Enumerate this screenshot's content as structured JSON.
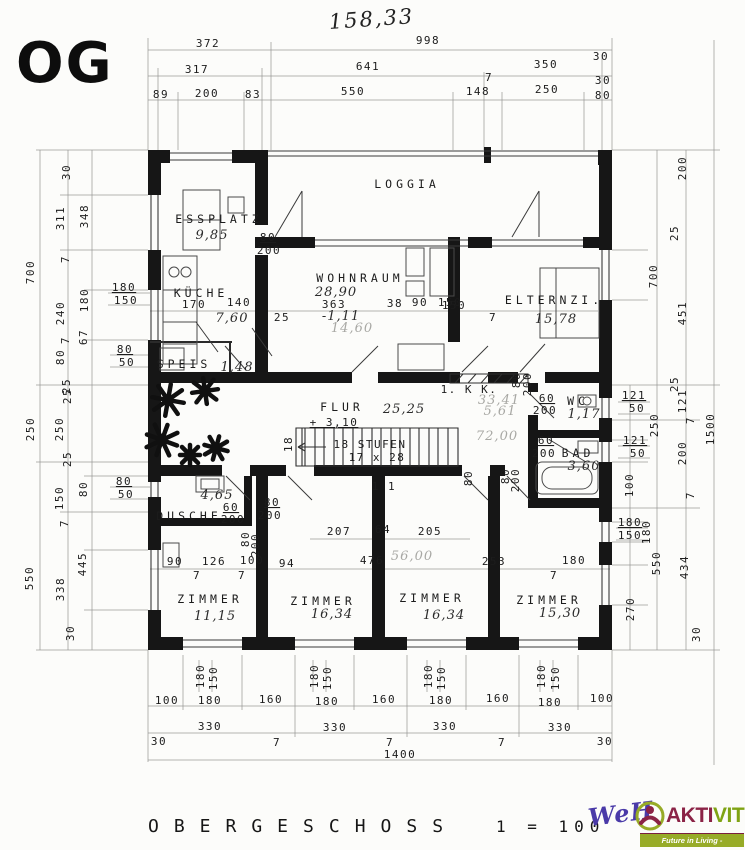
{
  "header": {
    "floor_code": "OG",
    "handwritten_total": "158,33"
  },
  "footer": {
    "title": "OBERGESCHOSS",
    "scale": "1 = 100",
    "logo": {
      "handwritten": "WeH",
      "brand_left": "AKTI",
      "brand_right": "VIT",
      "tagline": "Future in Living - Immobilien.",
      "colors": {
        "handwritten": "#4a3aa8",
        "brand_left": "#8b2346",
        "brand_right": "#7fa314",
        "banner_bg": "#97ab27",
        "tagline_text": "#ffffff"
      }
    }
  },
  "labels": [
    {
      "t": "372",
      "x": 208,
      "y": 47
    },
    {
      "t": "998",
      "x": 428,
      "y": 44
    },
    {
      "t": "317",
      "x": 197,
      "y": 73
    },
    {
      "t": "641",
      "x": 368,
      "y": 70
    },
    {
      "t": "7",
      "x": 489,
      "y": 81,
      "s": 10
    },
    {
      "t": "350",
      "x": 546,
      "y": 68
    },
    {
      "t": "30",
      "x": 601,
      "y": 60,
      "s": 10
    },
    {
      "t": "30",
      "x": 603,
      "y": 84,
      "s": 10
    },
    {
      "t": "89",
      "x": 161,
      "y": 98
    },
    {
      "t": "200",
      "x": 207,
      "y": 97
    },
    {
      "t": "83",
      "x": 253,
      "y": 98
    },
    {
      "t": "550",
      "x": 353,
      "y": 95
    },
    {
      "t": "148",
      "x": 478,
      "y": 95
    },
    {
      "t": "250",
      "x": 547,
      "y": 93
    },
    {
      "t": "80",
      "x": 603,
      "y": 99,
      "s": 10
    },
    {
      "t": "700",
      "x": 34,
      "y": 272,
      "r": -90
    },
    {
      "t": "30",
      "x": 70,
      "y": 172,
      "r": -90,
      "s": 10
    },
    {
      "t": "311",
      "x": 64,
      "y": 218,
      "r": -90
    },
    {
      "t": "348",
      "x": 88,
      "y": 216,
      "r": -90
    },
    {
      "t": "7",
      "x": 69,
      "y": 259,
      "r": -90,
      "s": 10
    },
    {
      "t": "240",
      "x": 64,
      "y": 313,
      "r": -90
    },
    {
      "t": "180",
      "x": 88,
      "y": 300,
      "r": -90
    },
    {
      "t": "180",
      "x": 124,
      "y": 291,
      "u": 1
    },
    {
      "t": "150",
      "x": 126,
      "y": 304
    },
    {
      "t": "67",
      "x": 87,
      "y": 337,
      "r": -90,
      "s": 10
    },
    {
      "t": "7",
      "x": 69,
      "y": 340,
      "r": -90,
      "s": 10
    },
    {
      "t": "80",
      "x": 64,
      "y": 357,
      "r": -90
    },
    {
      "t": "80",
      "x": 125,
      "y": 353,
      "u": 1
    },
    {
      "t": "50",
      "x": 127,
      "y": 366
    },
    {
      "t": "25",
      "x": 70,
      "y": 386,
      "r": -90,
      "s": 10
    },
    {
      "t": "250",
      "x": 34,
      "y": 429,
      "r": -90
    },
    {
      "t": "250",
      "x": 63,
      "y": 429,
      "r": -90
    },
    {
      "t": "25",
      "x": 71,
      "y": 396,
      "r": -90,
      "s": 10
    },
    {
      "t": "25",
      "x": 71,
      "y": 459,
      "r": -90,
      "s": 10
    },
    {
      "t": "80",
      "x": 124,
      "y": 485,
      "u": 1
    },
    {
      "t": "50",
      "x": 126,
      "y": 498
    },
    {
      "t": "80",
      "x": 87,
      "y": 489,
      "r": -90
    },
    {
      "t": "150",
      "x": 63,
      "y": 498,
      "r": -90
    },
    {
      "t": "7",
      "x": 68,
      "y": 523,
      "r": -90,
      "s": 10
    },
    {
      "t": "550",
      "x": 33,
      "y": 578,
      "r": -90
    },
    {
      "t": "445",
      "x": 86,
      "y": 564,
      "r": -90
    },
    {
      "t": "338",
      "x": 64,
      "y": 589,
      "r": -90
    },
    {
      "t": "30",
      "x": 74,
      "y": 633,
      "r": -90,
      "s": 10
    },
    {
      "t": "200",
      "x": 686,
      "y": 168,
      "r": -90
    },
    {
      "t": "25",
      "x": 678,
      "y": 233,
      "r": -90,
      "s": 10
    },
    {
      "t": "700",
      "x": 657,
      "y": 276,
      "r": -90
    },
    {
      "t": "451",
      "x": 686,
      "y": 313,
      "r": -90
    },
    {
      "t": "25",
      "x": 678,
      "y": 384,
      "r": -90,
      "s": 10
    },
    {
      "t": "121",
      "x": 634,
      "y": 399,
      "u": 1
    },
    {
      "t": "50",
      "x": 637,
      "y": 412
    },
    {
      "t": "250",
      "x": 658,
      "y": 425,
      "r": -90
    },
    {
      "t": "121",
      "x": 686,
      "y": 401,
      "r": -90
    },
    {
      "t": "7",
      "x": 694,
      "y": 420,
      "r": -90,
      "s": 10
    },
    {
      "t": "1500",
      "x": 714,
      "y": 429,
      "r": -90
    },
    {
      "t": "121",
      "x": 635,
      "y": 444,
      "u": 1
    },
    {
      "t": "50",
      "x": 638,
      "y": 457
    },
    {
      "t": "200",
      "x": 686,
      "y": 453,
      "r": -90
    },
    {
      "t": "100",
      "x": 633,
      "y": 485,
      "r": -90
    },
    {
      "t": "7",
      "x": 694,
      "y": 495,
      "r": -90,
      "s": 10
    },
    {
      "t": "180",
      "x": 630,
      "y": 526,
      "u": 1
    },
    {
      "t": "150",
      "x": 630,
      "y": 539
    },
    {
      "t": "180",
      "x": 650,
      "y": 532,
      "r": -90
    },
    {
      "t": "550",
      "x": 660,
      "y": 563,
      "r": -90
    },
    {
      "t": "434",
      "x": 688,
      "y": 567,
      "r": -90
    },
    {
      "t": "270",
      "x": 634,
      "y": 609,
      "r": -90
    },
    {
      "t": "30",
      "x": 700,
      "y": 634,
      "r": -90,
      "s": 10
    },
    {
      "t": "180",
      "x": 204,
      "y": 676,
      "r": -90,
      "s": 10
    },
    {
      "t": "150",
      "x": 217,
      "y": 678,
      "r": -90,
      "s": 10
    },
    {
      "t": "180",
      "x": 318,
      "y": 676,
      "r": -90,
      "s": 10
    },
    {
      "t": "150",
      "x": 331,
      "y": 678,
      "r": -90,
      "s": 10
    },
    {
      "t": "180",
      "x": 432,
      "y": 676,
      "r": -90,
      "s": 10
    },
    {
      "t": "150",
      "x": 445,
      "y": 678,
      "r": -90,
      "s": 10
    },
    {
      "t": "180",
      "x": 545,
      "y": 676,
      "r": -90,
      "s": 10
    },
    {
      "t": "150",
      "x": 559,
      "y": 678,
      "r": -90,
      "s": 10
    },
    {
      "t": "100",
      "x": 167,
      "y": 704
    },
    {
      "t": "180",
      "x": 210,
      "y": 704
    },
    {
      "t": "160",
      "x": 271,
      "y": 703
    },
    {
      "t": "180",
      "x": 327,
      "y": 705
    },
    {
      "t": "160",
      "x": 384,
      "y": 703
    },
    {
      "t": "180",
      "x": 441,
      "y": 704
    },
    {
      "t": "160",
      "x": 498,
      "y": 702
    },
    {
      "t": "180",
      "x": 550,
      "y": 706
    },
    {
      "t": "100",
      "x": 602,
      "y": 702
    },
    {
      "t": "330",
      "x": 210,
      "y": 730
    },
    {
      "t": "7",
      "x": 277,
      "y": 746,
      "s": 10
    },
    {
      "t": "330",
      "x": 335,
      "y": 731
    },
    {
      "t": "7",
      "x": 390,
      "y": 746,
      "s": 10
    },
    {
      "t": "330",
      "x": 445,
      "y": 730
    },
    {
      "t": "7",
      "x": 502,
      "y": 746,
      "s": 10
    },
    {
      "t": "330",
      "x": 560,
      "y": 731
    },
    {
      "t": "30",
      "x": 159,
      "y": 745,
      "s": 10
    },
    {
      "t": "30",
      "x": 605,
      "y": 745,
      "s": 10
    },
    {
      "t": "1400",
      "x": 400,
      "y": 758
    },
    {
      "t": "LOGGIA",
      "x": 407,
      "y": 188,
      "ls": 1,
      "n": "room-label-loggia"
    },
    {
      "t": "ESSPLATZ",
      "x": 219,
      "y": 223,
      "ls": 1,
      "n": "room-label-essplatz"
    },
    {
      "t": "9,85",
      "x": 212,
      "y": 239,
      "h": 1,
      "n": "area-essplatz"
    },
    {
      "t": "80",
      "x": 268,
      "y": 241,
      "u": 1
    },
    {
      "t": "200",
      "x": 269,
      "y": 254
    },
    {
      "t": "WOHNRAUM",
      "x": 360,
      "y": 282,
      "ls": 1,
      "n": "room-label-wohnraum"
    },
    {
      "t": "28,90",
      "x": 336,
      "y": 296,
      "h": 1,
      "n": "area-wohnraum"
    },
    {
      "t": "363",
      "x": 334,
      "y": 308
    },
    {
      "t": "-1,11",
      "x": 341,
      "y": 320,
      "h": 1
    },
    {
      "t": "14,60",
      "x": 352,
      "y": 332,
      "h": 1,
      "f": 1
    },
    {
      "t": "38",
      "x": 395,
      "y": 307
    },
    {
      "t": "90",
      "x": 420,
      "y": 306
    },
    {
      "t": "150",
      "x": 450,
      "y": 306
    },
    {
      "t": "25",
      "x": 282,
      "y": 321
    },
    {
      "t": "KÜCHE",
      "x": 201,
      "y": 297,
      "ls": 1,
      "n": "room-label-kueche"
    },
    {
      "t": "170",
      "x": 194,
      "y": 308
    },
    {
      "t": "140",
      "x": 239,
      "y": 306
    },
    {
      "t": "7,60",
      "x": 232,
      "y": 322,
      "h": 1,
      "n": "area-kueche"
    },
    {
      "t": "SPEIS",
      "x": 184,
      "y": 368,
      "ls": 1,
      "n": "room-label-speis"
    },
    {
      "t": "1,48",
      "x": 237,
      "y": 371,
      "h": 1,
      "n": "area-speis"
    },
    {
      "t": "ELTERNZI.",
      "x": 554,
      "y": 304,
      "ls": 1,
      "n": "room-label-elternzimmer"
    },
    {
      "t": "15,78",
      "x": 556,
      "y": 323,
      "h": 1,
      "s": 15,
      "n": "area-elternzimmer"
    },
    {
      "t": "150",
      "x": 454,
      "y": 309
    },
    {
      "t": "7",
      "x": 493,
      "y": 321,
      "s": 10
    },
    {
      "t": "1. K K.",
      "x": 469,
      "y": 393,
      "n": "label-kochkueche"
    },
    {
      "t": "80",
      "x": 520,
      "y": 380,
      "r": -90,
      "s": 10
    },
    {
      "t": "200",
      "x": 531,
      "y": 384,
      "r": -90,
      "s": 10
    },
    {
      "t": "60",
      "x": 547,
      "y": 402,
      "u": 1
    },
    {
      "t": "200",
      "x": 545,
      "y": 414
    },
    {
      "t": "WC",
      "x": 578,
      "y": 405,
      "ls": 1,
      "n": "room-label-wc"
    },
    {
      "t": "1,17",
      "x": 584,
      "y": 418,
      "h": 1,
      "n": "area-wc"
    },
    {
      "t": "33,41",
      "x": 499,
      "y": 404,
      "h": 1,
      "f": 1,
      "s": 10
    },
    {
      "t": "5,61",
      "x": 500,
      "y": 415,
      "h": 1,
      "f": 1,
      "s": 10
    },
    {
      "t": "72,00",
      "x": 497,
      "y": 440,
      "h": 1,
      "f": 1,
      "s": 10
    },
    {
      "t": "60",
      "x": 546,
      "y": 444,
      "u": 1
    },
    {
      "t": "200",
      "x": 544,
      "y": 457
    },
    {
      "t": "BAD",
      "x": 578,
      "y": 457,
      "ls": 1,
      "n": "room-label-bad"
    },
    {
      "t": "3,60",
      "x": 584,
      "y": 470,
      "h": 1,
      "n": "area-bad"
    },
    {
      "t": "FLUR",
      "x": 342,
      "y": 411,
      "ls": 1,
      "n": "room-label-flur"
    },
    {
      "t": "25,25",
      "x": 404,
      "y": 413,
      "h": 1,
      "s": 15,
      "n": "area-flur"
    },
    {
      "t": "+ 3,10",
      "x": 334,
      "y": 426,
      "u": 1
    },
    {
      "t": "18 STUFEN",
      "x": 370,
      "y": 448,
      "n": "stairs-count-label"
    },
    {
      "t": "17 x 28",
      "x": 377,
      "y": 461,
      "n": "stairs-rise-run-label"
    },
    {
      "t": "18",
      "x": 292,
      "y": 444,
      "r": -90,
      "s": 10
    },
    {
      "t": "80",
      "x": 472,
      "y": 478,
      "r": -90,
      "s": 10
    },
    {
      "t": "1 1",
      "x": 384,
      "y": 490,
      "s": 10
    },
    {
      "t": "DUSCHE",
      "x": 189,
      "y": 520,
      "ls": 1,
      "n": "room-label-dusche"
    },
    {
      "t": "4,65",
      "x": 217,
      "y": 499,
      "h": 1,
      "n": "area-dusche"
    },
    {
      "t": "60",
      "x": 231,
      "y": 511,
      "u": 1
    },
    {
      "t": "200",
      "x": 233,
      "y": 523
    },
    {
      "t": "80",
      "x": 272,
      "y": 506,
      "u": 1
    },
    {
      "t": "200",
      "x": 270,
      "y": 519
    },
    {
      "t": "80",
      "x": 249,
      "y": 539,
      "r": -90,
      "s": 10
    },
    {
      "t": "200",
      "x": 259,
      "y": 545,
      "r": -90,
      "s": 10
    },
    {
      "t": "207",
      "x": 339,
      "y": 535
    },
    {
      "t": "64",
      "x": 383,
      "y": 533
    },
    {
      "t": "205",
      "x": 430,
      "y": 535
    },
    {
      "t": "90",
      "x": 175,
      "y": 565
    },
    {
      "t": "126",
      "x": 214,
      "y": 565
    },
    {
      "t": "100",
      "x": 252,
      "y": 564
    },
    {
      "t": "94",
      "x": 287,
      "y": 567
    },
    {
      "t": "476",
      "x": 372,
      "y": 564
    },
    {
      "t": "56,00",
      "x": 412,
      "y": 560,
      "h": 1,
      "f": 1,
      "s": 10
    },
    {
      "t": "7",
      "x": 197,
      "y": 579,
      "s": 10
    },
    {
      "t": "7",
      "x": 242,
      "y": 579,
      "s": 10
    },
    {
      "t": "253",
      "x": 494,
      "y": 565
    },
    {
      "t": "180",
      "x": 574,
      "y": 564
    },
    {
      "t": "7",
      "x": 554,
      "y": 579,
      "s": 10
    },
    {
      "t": "ZIMMER",
      "x": 210,
      "y": 603,
      "ls": 1,
      "n": "room-label-zimmer-1"
    },
    {
      "t": "11,15",
      "x": 215,
      "y": 620,
      "h": 1,
      "s": 15,
      "n": "area-zimmer-1"
    },
    {
      "t": "ZIMMER",
      "x": 323,
      "y": 605,
      "ls": 1,
      "n": "room-label-zimmer-2"
    },
    {
      "t": "16,34",
      "x": 332,
      "y": 618,
      "h": 1,
      "s": 15,
      "n": "area-zimmer-2"
    },
    {
      "t": "ZIMMER",
      "x": 432,
      "y": 602,
      "ls": 1,
      "n": "room-label-zimmer-3"
    },
    {
      "t": "16,34",
      "x": 444,
      "y": 619,
      "h": 1,
      "s": 15,
      "n": "area-zimmer-3"
    },
    {
      "t": "ZIMMER",
      "x": 549,
      "y": 604,
      "ls": 1,
      "n": "room-label-zimmer-4"
    },
    {
      "t": "15,30",
      "x": 560,
      "y": 617,
      "h": 1,
      "s": 15,
      "n": "area-zimmer-4"
    },
    {
      "t": "80",
      "x": 509,
      "y": 476,
      "r": -90,
      "s": 10
    },
    {
      "t": "200",
      "x": 519,
      "y": 480,
      "r": -90,
      "s": 10
    }
  ]
}
